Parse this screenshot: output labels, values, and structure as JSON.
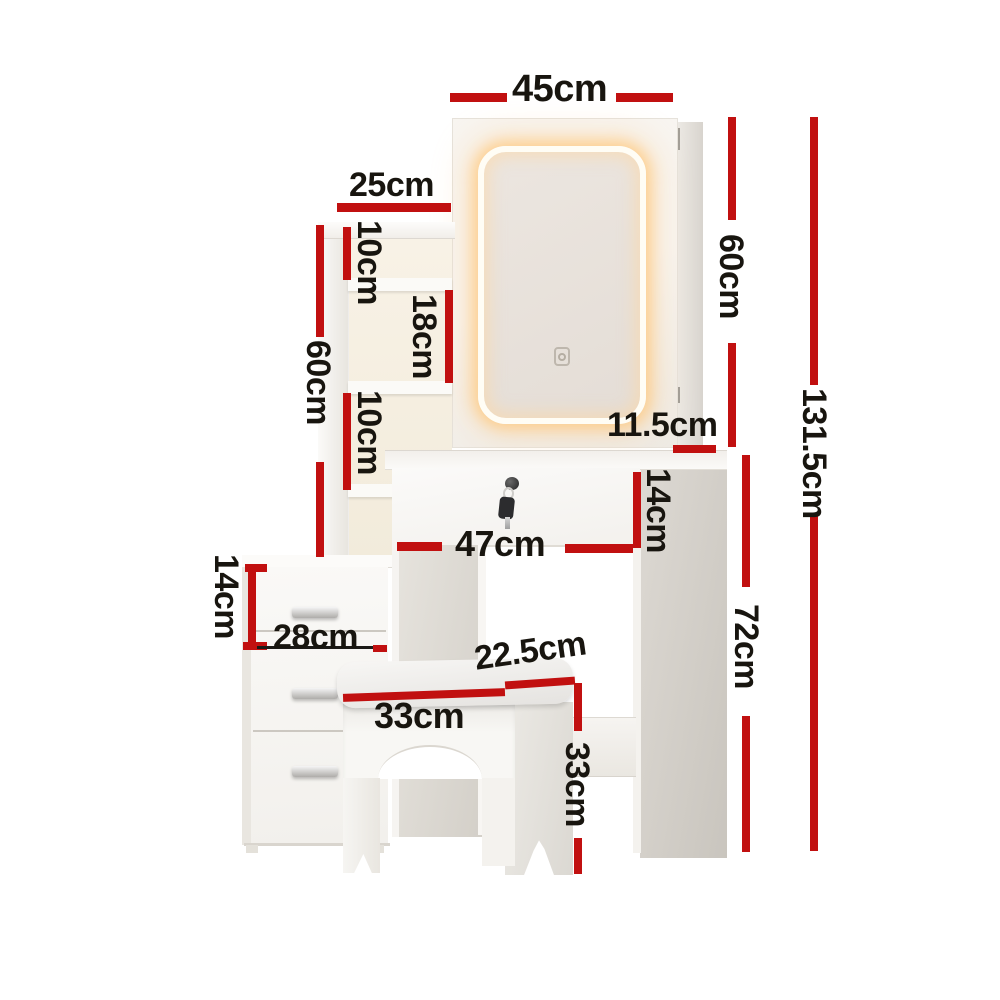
{
  "title": "Dressing table with LED mirror, shelves, drawers and stool - dimension diagram",
  "style": {
    "dimension_color": "#c11010",
    "text_color": "#18150f",
    "led_glow_color": "#ffc87a"
  },
  "icons": {
    "touch_switch": "touch-switch-icon",
    "lock": "lock-icon",
    "key": "key-icon"
  },
  "dims": {
    "mirror_width": "45cm",
    "shelf_width": "25cm",
    "cubby_top": "10cm",
    "cubby_middle": "18cm",
    "cubby_lower": "10cm",
    "hutch_height": "60cm",
    "mirror_height": "60cm",
    "overall_height": "131.5cm",
    "side_ledge_depth": "11.5cm",
    "desk_drawer_height": "14cm",
    "desk_width": "47cm",
    "chest_drawer_height": "14cm",
    "chest_width": "28cm",
    "stool_depth": "22.5cm",
    "stool_width": "33cm",
    "stool_height": "33cm",
    "desk_height": "72cm"
  }
}
